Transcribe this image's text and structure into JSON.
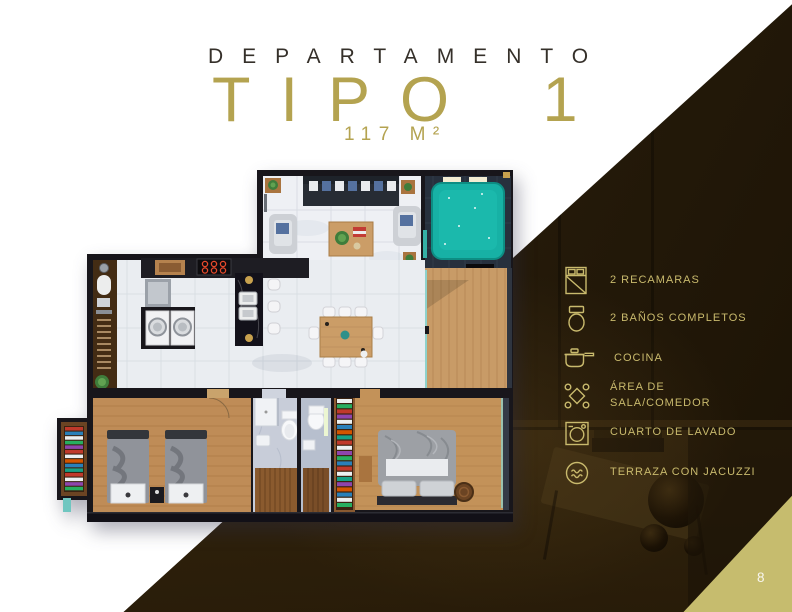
{
  "title": {
    "kicker": "DEPARTAMENTO",
    "name": "TIPO 1",
    "area": "117 M²"
  },
  "amenities": [
    {
      "icon": "bed-icon",
      "label": "2 RECAMARAS"
    },
    {
      "icon": "toilet-icon",
      "label": "2 BAÑOS COMPLETOS"
    },
    {
      "icon": "cookware-icon",
      "label": "COCINA"
    },
    {
      "icon": "dining-table-icon",
      "label": "ÁREA DE SALA/COMEDOR"
    },
    {
      "icon": "washing-machine-icon",
      "label": "CUARTO DE LAVADO"
    },
    {
      "icon": "jacuzzi-icon",
      "label": "TERRAZA CON JACUZZI"
    }
  ],
  "page": {
    "number": "8"
  },
  "colors": {
    "accent_gold_title": "#b4a350",
    "list_gold": "#c9ba6d",
    "kicker_dark": "#35302a",
    "dark_overlay": "#271c0b",
    "corner_triangle": "#c6bc6e",
    "jacuzzi_teal": "#17b1a5",
    "page_background": "#ffffff"
  }
}
